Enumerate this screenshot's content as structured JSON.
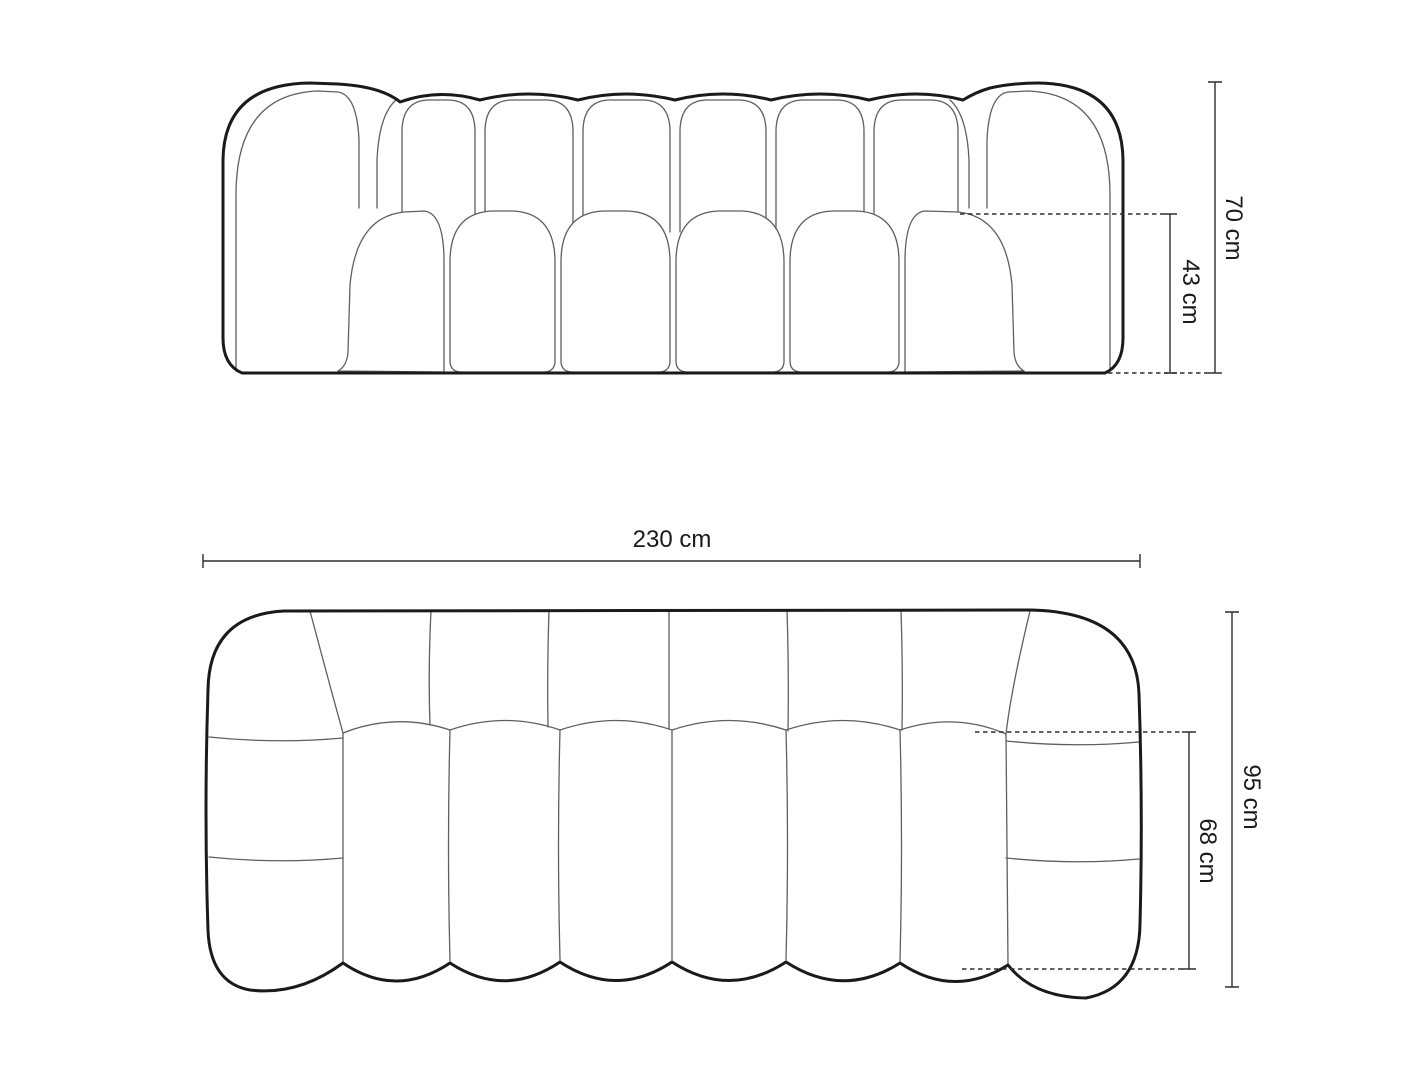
{
  "drawing": {
    "subject": "sofa",
    "views": {
      "front": {
        "name": "front-elevation",
        "back_channels": 6,
        "seat_cushions": 6,
        "dimensions": {
          "total_height": {
            "label": "70 cm",
            "value": 70,
            "unit": "cm"
          },
          "seat_height": {
            "label": "43 cm",
            "value": 43,
            "unit": "cm"
          }
        }
      },
      "top": {
        "name": "plan-top-view",
        "back_channels": 6,
        "seat_channels": 6,
        "arm_segments": 3,
        "dimensions": {
          "total_width": {
            "label": "230 cm",
            "value": 230,
            "unit": "cm"
          },
          "total_depth": {
            "label": "95 cm",
            "value": 95,
            "unit": "cm"
          },
          "seat_depth": {
            "label": "68 cm",
            "value": 68,
            "unit": "cm"
          }
        }
      }
    }
  },
  "colors": {
    "outline": "#1a1a1a",
    "seam": "#5f5f5f",
    "dimension": "#2e2e2e",
    "label": "#1a1a1a",
    "bg": "#ffffff"
  }
}
